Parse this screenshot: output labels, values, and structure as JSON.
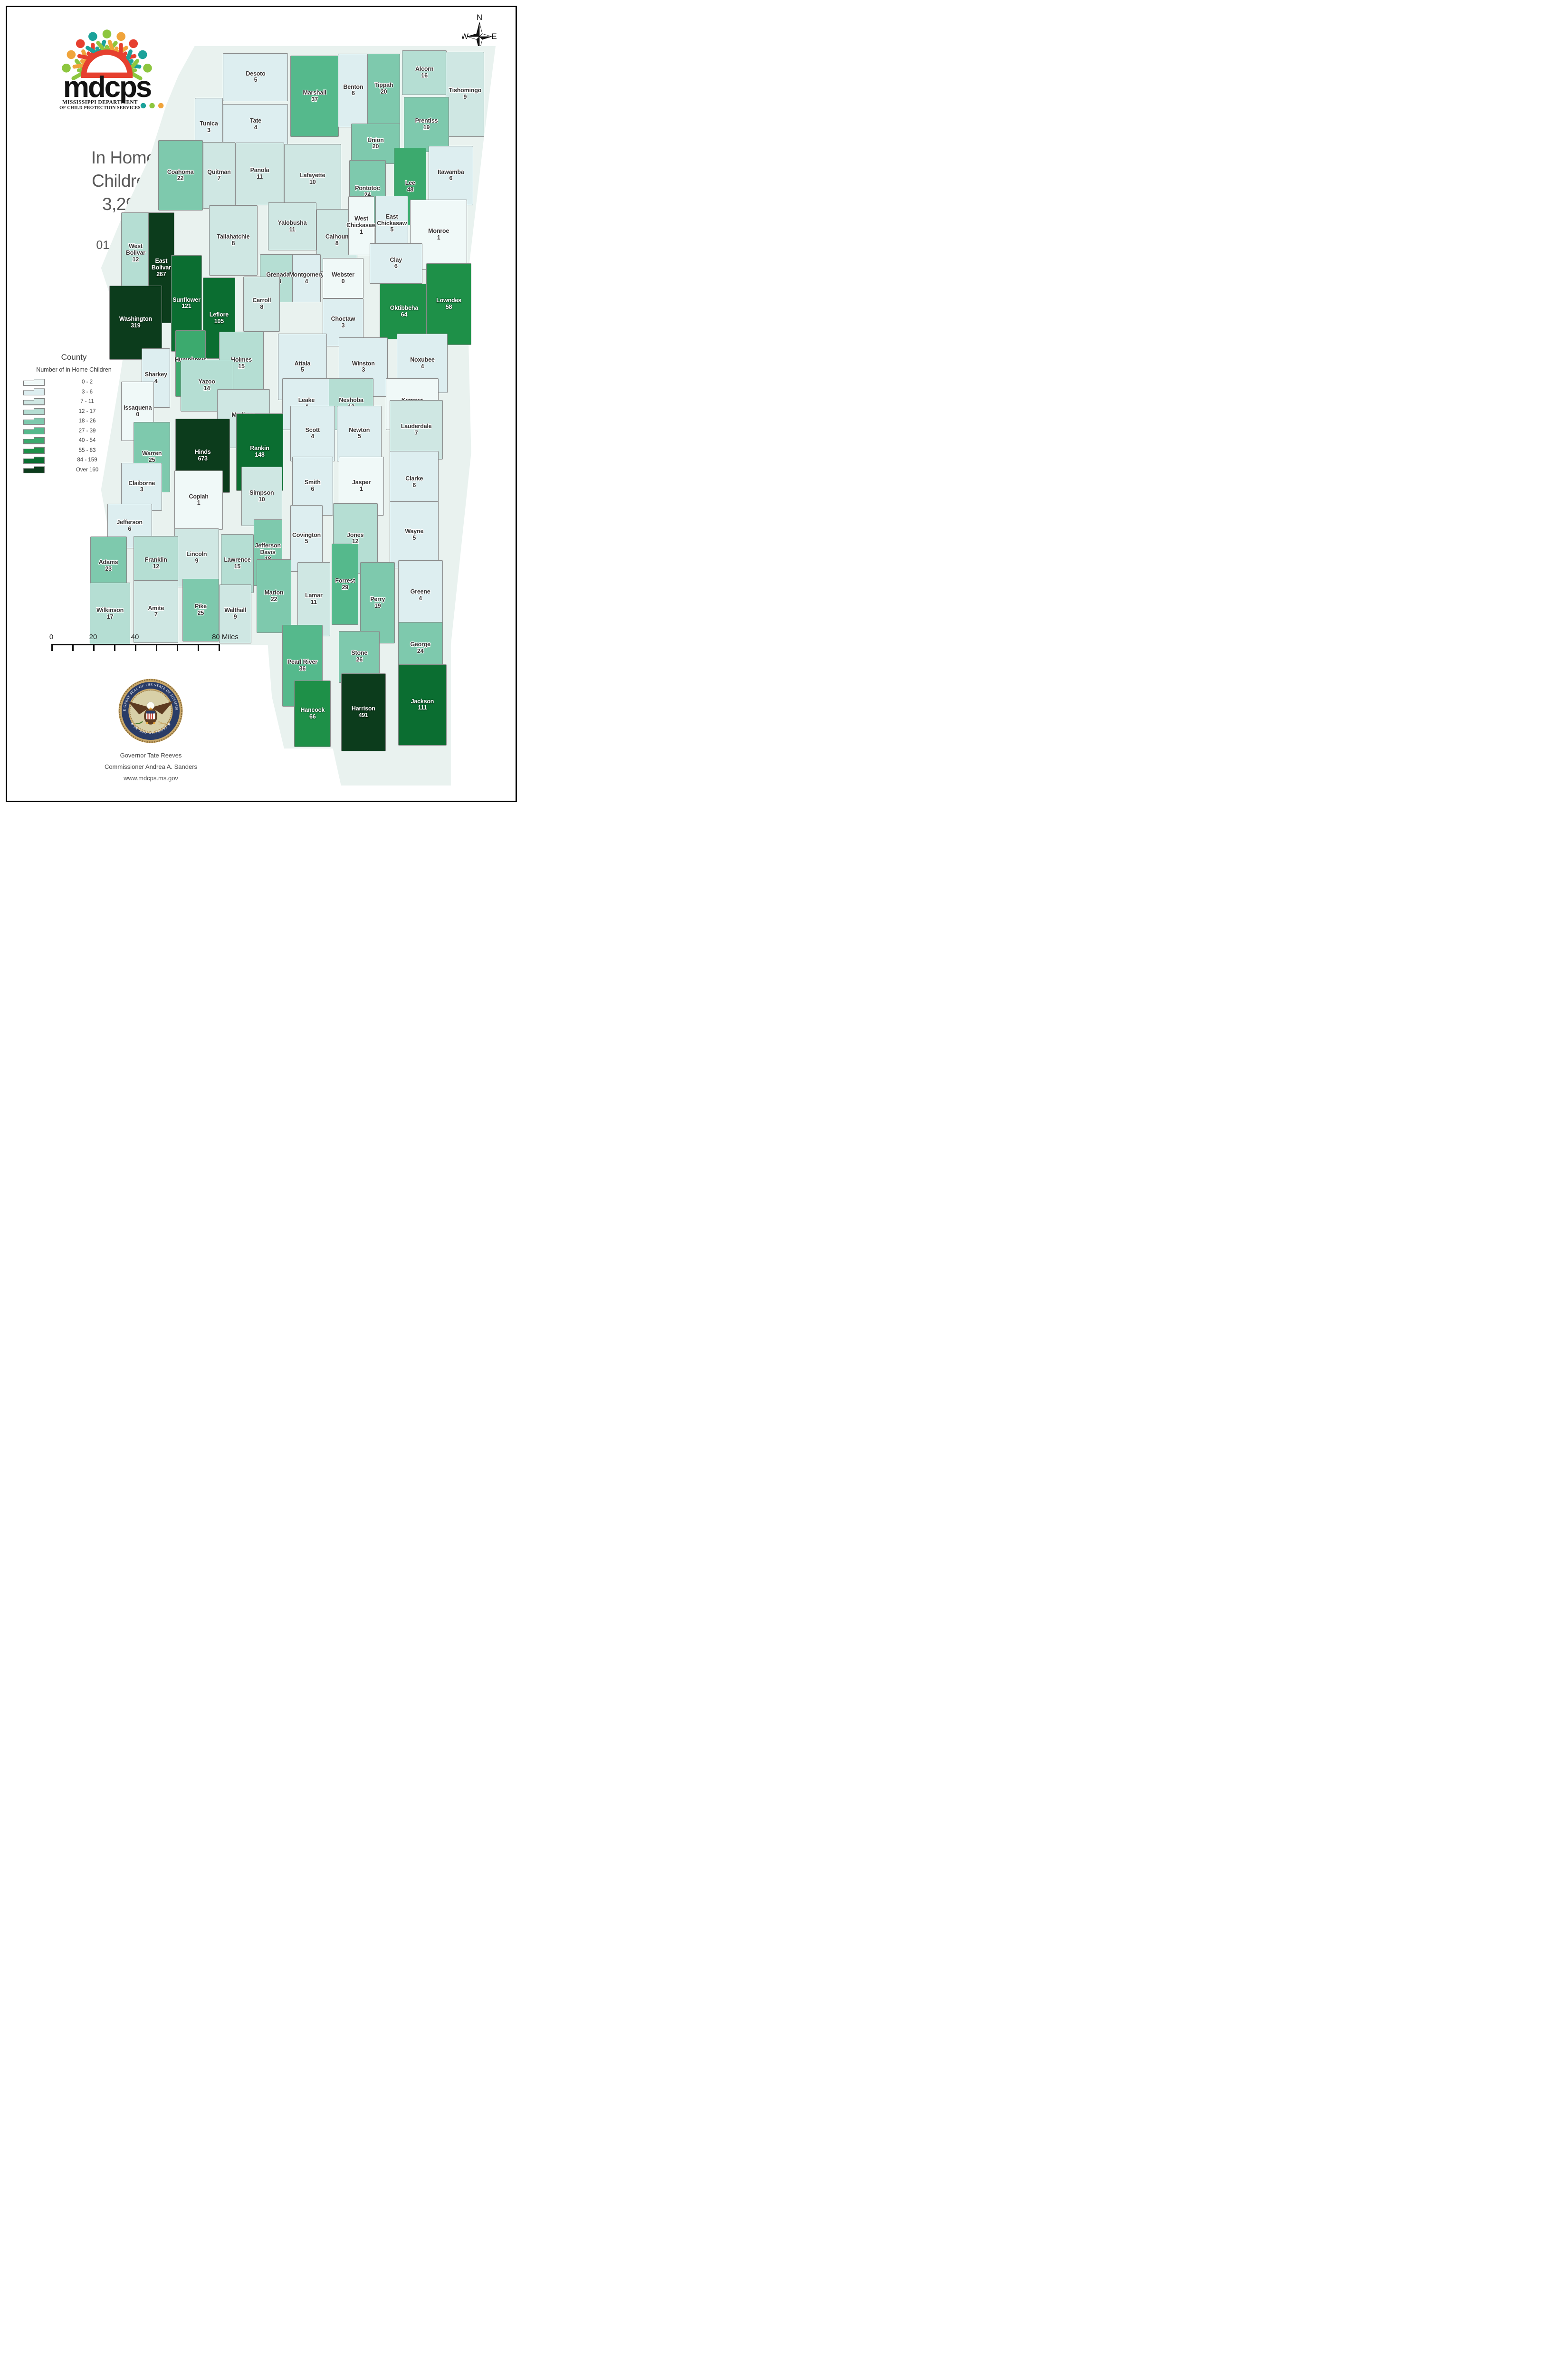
{
  "header": {
    "title_line1": "In Home",
    "title_line2": "Children",
    "total": "3,293",
    "date": "01-Mar-26"
  },
  "logo": {
    "wordmark": "mdcps",
    "dept_line1": "MISSISSIPPI DEPARTMENT",
    "dept_line2": "OF CHILD PROTECTION SERVICES",
    "palette": [
      "#1ba29a",
      "#8dc63f",
      "#f0a43b",
      "#e6402f"
    ]
  },
  "compass": {
    "n": "N",
    "e": "E",
    "s": "S",
    "w": "W"
  },
  "legend": {
    "title": "County",
    "subtitle": "Number of in Home Children",
    "classes": [
      {
        "label": "0 - 2",
        "color": "#f0f9f8"
      },
      {
        "label": "3 - 6",
        "color": "#ddeef0"
      },
      {
        "label": "7 - 11",
        "color": "#cfe7e3"
      },
      {
        "label": "12 - 17",
        "color": "#b5ded3"
      },
      {
        "label": "18 - 26",
        "color": "#7ec9ad"
      },
      {
        "label": "27 - 39",
        "color": "#55b98c"
      },
      {
        "label": "40 - 54",
        "color": "#3caa6e"
      },
      {
        "label": "55 - 83",
        "color": "#1e9048"
      },
      {
        "label": "84 - 159",
        "color": "#0b6e31"
      },
      {
        "label": "Over 160",
        "color": "#0c3c1c"
      }
    ]
  },
  "scalebar": {
    "labels": [
      "0",
      "20",
      "40",
      "80 Miles"
    ]
  },
  "seal": {
    "ring_text_top": "THE GREAT SEAL OF THE STATE OF MISSISSIPPI",
    "ring_text_bottom": "★ IN GOD WE TRUST ★"
  },
  "credits": {
    "line1": "Governor Tate Reeves",
    "line2": "Commissioner Andrea A. Sanders",
    "line3": "www.mdcps.ms.gov"
  },
  "map": {
    "type": "choropleth",
    "region": "Mississippi counties",
    "class_colors": [
      "#f0f9f8",
      "#ddeef0",
      "#cfe7e3",
      "#b5ded3",
      "#7ec9ad",
      "#55b98c",
      "#3caa6e",
      "#1e9048",
      "#0b6e31",
      "#0c3c1c"
    ],
    "counties": [
      {
        "name": "Desoto",
        "value": 5,
        "cls": 2,
        "x": 41,
        "y": 4.2,
        "w": 16,
        "h": 6.5
      },
      {
        "name": "Marshall",
        "value": 37,
        "cls": 6,
        "x": 55.5,
        "y": 6.8,
        "w": 12,
        "h": 11
      },
      {
        "name": "Benton",
        "value": 6,
        "cls": 2,
        "x": 65,
        "y": 6,
        "w": 7.5,
        "h": 10
      },
      {
        "name": "Tippah",
        "value": 20,
        "cls": 5,
        "x": 72.5,
        "y": 5.8,
        "w": 8,
        "h": 9.5
      },
      {
        "name": "Alcorn",
        "value": 16,
        "cls": 4,
        "x": 82.5,
        "y": 3.6,
        "w": 11,
        "h": 6
      },
      {
        "name": "Tishomingo",
        "value": 9,
        "cls": 3,
        "x": 92.5,
        "y": 6.5,
        "w": 9.5,
        "h": 11.5
      },
      {
        "name": "Tunica",
        "value": 3,
        "cls": 2,
        "x": 29.5,
        "y": 11,
        "w": 7,
        "h": 8
      },
      {
        "name": "Tate",
        "value": 4,
        "cls": 2,
        "x": 41,
        "y": 10.6,
        "w": 16,
        "h": 5.5
      },
      {
        "name": "Prentiss",
        "value": 19,
        "cls": 5,
        "x": 83,
        "y": 10.6,
        "w": 11,
        "h": 7.5
      },
      {
        "name": "Union",
        "value": 20,
        "cls": 5,
        "x": 70.5,
        "y": 13.2,
        "w": 12,
        "h": 5.5
      },
      {
        "name": "Coahoma",
        "value": 22,
        "cls": 5,
        "x": 22.5,
        "y": 17.5,
        "w": 11,
        "h": 9.5
      },
      {
        "name": "Quitman",
        "value": 7,
        "cls": 3,
        "x": 32,
        "y": 17.5,
        "w": 8,
        "h": 9
      },
      {
        "name": "Panola",
        "value": 11,
        "cls": 3,
        "x": 42,
        "y": 17.3,
        "w": 12,
        "h": 8.5
      },
      {
        "name": "Lafayette",
        "value": 10,
        "cls": 3,
        "x": 55,
        "y": 18,
        "w": 14,
        "h": 9.5
      },
      {
        "name": "Pontotoc",
        "value": 24,
        "cls": 5,
        "x": 68.5,
        "y": 19.7,
        "w": 9,
        "h": 8.5
      },
      {
        "name": "Lee",
        "value": 48,
        "cls": 7,
        "x": 79,
        "y": 19,
        "w": 8,
        "h": 10.5
      },
      {
        "name": "Itawamba",
        "value": 6,
        "cls": 2,
        "x": 89,
        "y": 17.5,
        "w": 11,
        "h": 8
      },
      {
        "name": "Monroe",
        "value": 1,
        "cls": 1,
        "x": 86,
        "y": 25.5,
        "w": 14,
        "h": 9.5
      },
      {
        "name": "Tallahatchie",
        "value": 8,
        "cls": 3,
        "x": 35.5,
        "y": 26.3,
        "w": 12,
        "h": 9.5
      },
      {
        "name": "Yalobusha",
        "value": 11,
        "cls": 3,
        "x": 50,
        "y": 24.4,
        "w": 12,
        "h": 6.5
      },
      {
        "name": "Calhoun",
        "value": 8,
        "cls": 3,
        "x": 61,
        "y": 26.3,
        "w": 10,
        "h": 8.5
      },
      {
        "name": "West Chickasaw",
        "value": 1,
        "cls": 1,
        "x": 67,
        "y": 24.3,
        "w": 6.5,
        "h": 8
      },
      {
        "name": "East Chickasaw",
        "value": 5,
        "cls": 2,
        "x": 74.5,
        "y": 24,
        "w": 8,
        "h": 7.5
      },
      {
        "name": "West Bolivar",
        "value": 12,
        "cls": 4,
        "x": 11.5,
        "y": 28,
        "w": 7,
        "h": 11
      },
      {
        "name": "East Bolivar",
        "value": 267,
        "cls": 10,
        "x": 17.8,
        "y": 30,
        "w": 6.5,
        "h": 15
      },
      {
        "name": "Sunflower",
        "value": 121,
        "cls": 9,
        "x": 24,
        "y": 34.8,
        "w": 7.5,
        "h": 13
      },
      {
        "name": "Leflore",
        "value": 105,
        "cls": 9,
        "x": 32,
        "y": 36.8,
        "w": 8,
        "h": 11
      },
      {
        "name": "Grenada",
        "value": 13,
        "cls": 4,
        "x": 46.5,
        "y": 31.4,
        "w": 9,
        "h": 6.5
      },
      {
        "name": "Montgomery",
        "value": 4,
        "cls": 2,
        "x": 53.5,
        "y": 31.4,
        "w": 7,
        "h": 6.5
      },
      {
        "name": "Webster",
        "value": 0,
        "cls": 1,
        "x": 62.5,
        "y": 31.4,
        "w": 10,
        "h": 5.5
      },
      {
        "name": "Clay",
        "value": 6,
        "cls": 2,
        "x": 75.5,
        "y": 29.4,
        "w": 13,
        "h": 5.5
      },
      {
        "name": "Washington",
        "value": 319,
        "cls": 10,
        "x": 11.5,
        "y": 37.4,
        "w": 13,
        "h": 10
      },
      {
        "name": "Humphreys",
        "value": 52,
        "cls": 7,
        "x": 25,
        "y": 42.9,
        "w": 7.5,
        "h": 9
      },
      {
        "name": "Sharkey",
        "value": 4,
        "cls": 2,
        "x": 16.5,
        "y": 44.9,
        "w": 7,
        "h": 8
      },
      {
        "name": "Carroll",
        "value": 8,
        "cls": 3,
        "x": 42.5,
        "y": 34.9,
        "w": 9,
        "h": 7.5
      },
      {
        "name": "Holmes",
        "value": 15,
        "cls": 4,
        "x": 37.5,
        "y": 42.9,
        "w": 11,
        "h": 8.5
      },
      {
        "name": "Choctaw",
        "value": 3,
        "cls": 2,
        "x": 62.5,
        "y": 37.4,
        "w": 10,
        "h": 6.5
      },
      {
        "name": "Oktibbeha",
        "value": 64,
        "cls": 8,
        "x": 77.5,
        "y": 35.9,
        "w": 12,
        "h": 7.5
      },
      {
        "name": "Lowndes",
        "value": 58,
        "cls": 8,
        "x": 88.5,
        "y": 34.9,
        "w": 11,
        "h": 11
      },
      {
        "name": "Attala",
        "value": 5,
        "cls": 2,
        "x": 52.5,
        "y": 43.4,
        "w": 12,
        "h": 9
      },
      {
        "name": "Winston",
        "value": 3,
        "cls": 2,
        "x": 67.5,
        "y": 43.4,
        "w": 12,
        "h": 8
      },
      {
        "name": "Noxubee",
        "value": 4,
        "cls": 2,
        "x": 82,
        "y": 42.9,
        "w": 12.5,
        "h": 8
      },
      {
        "name": "Yazoo",
        "value": 14,
        "cls": 4,
        "x": 29,
        "y": 45.9,
        "w": 13,
        "h": 7
      },
      {
        "name": "Leake",
        "value": 4,
        "cls": 2,
        "x": 53.5,
        "y": 48.4,
        "w": 12,
        "h": 7
      },
      {
        "name": "Neshoba",
        "value": 12,
        "cls": 4,
        "x": 64.5,
        "y": 48.4,
        "w": 11,
        "h": 7
      },
      {
        "name": "Kemper",
        "value": 0,
        "cls": 1,
        "x": 79.5,
        "y": 48.4,
        "w": 13,
        "h": 7
      },
      {
        "name": "Issaquena",
        "value": 0,
        "cls": 1,
        "x": 12,
        "y": 49.4,
        "w": 8,
        "h": 8
      },
      {
        "name": "Madison",
        "value": 8,
        "cls": 3,
        "x": 38,
        "y": 50.4,
        "w": 13,
        "h": 8
      },
      {
        "name": "Warren",
        "value": 25,
        "cls": 5,
        "x": 15.5,
        "y": 55.6,
        "w": 9,
        "h": 9.5
      },
      {
        "name": "Hinds",
        "value": 673,
        "cls": 10,
        "x": 28,
        "y": 55.4,
        "w": 13.5,
        "h": 10
      },
      {
        "name": "Rankin",
        "value": 148,
        "cls": 9,
        "x": 42,
        "y": 54.9,
        "w": 11.5,
        "h": 10.5
      },
      {
        "name": "Scott",
        "value": 4,
        "cls": 2,
        "x": 55,
        "y": 52.4,
        "w": 11,
        "h": 7.5
      },
      {
        "name": "Newton",
        "value": 5,
        "cls": 2,
        "x": 66.5,
        "y": 52.4,
        "w": 11,
        "h": 7.5
      },
      {
        "name": "Lauderdale",
        "value": 7,
        "cls": 3,
        "x": 80.5,
        "y": 51.9,
        "w": 13,
        "h": 8
      },
      {
        "name": "Claiborne",
        "value": 3,
        "cls": 2,
        "x": 13,
        "y": 59.6,
        "w": 10,
        "h": 6.5
      },
      {
        "name": "Copiah",
        "value": 1,
        "cls": 1,
        "x": 27,
        "y": 61.4,
        "w": 12,
        "h": 8
      },
      {
        "name": "Simpson",
        "value": 10,
        "cls": 3,
        "x": 42.5,
        "y": 60.9,
        "w": 10,
        "h": 8
      },
      {
        "name": "Smith",
        "value": 6,
        "cls": 2,
        "x": 55,
        "y": 59.5,
        "w": 10,
        "h": 8
      },
      {
        "name": "Jasper",
        "value": 1,
        "cls": 1,
        "x": 67,
        "y": 59.5,
        "w": 11,
        "h": 8
      },
      {
        "name": "Clarke",
        "value": 6,
        "cls": 2,
        "x": 80,
        "y": 59,
        "w": 12,
        "h": 8.5
      },
      {
        "name": "Jefferson",
        "value": 6,
        "cls": 2,
        "x": 10,
        "y": 64.9,
        "w": 11,
        "h": 6
      },
      {
        "name": "Lincoln",
        "value": 9,
        "cls": 3,
        "x": 26.5,
        "y": 69.2,
        "w": 11,
        "h": 8
      },
      {
        "name": "Lawrence",
        "value": 15,
        "cls": 4,
        "x": 36.5,
        "y": 70,
        "w": 8,
        "h": 8
      },
      {
        "name": "Jefferson Davis",
        "value": 18,
        "cls": 5,
        "x": 44,
        "y": 68.5,
        "w": 7,
        "h": 9
      },
      {
        "name": "Covington",
        "value": 5,
        "cls": 2,
        "x": 53.5,
        "y": 66.6,
        "w": 8,
        "h": 9
      },
      {
        "name": "Jones",
        "value": 12,
        "cls": 4,
        "x": 65.5,
        "y": 66.6,
        "w": 11,
        "h": 9.5
      },
      {
        "name": "Wayne",
        "value": 5,
        "cls": 2,
        "x": 80,
        "y": 66.1,
        "w": 12,
        "h": 9
      },
      {
        "name": "Adams",
        "value": 23,
        "cls": 5,
        "x": 4.8,
        "y": 70.3,
        "w": 9,
        "h": 8
      },
      {
        "name": "Franklin",
        "value": 12,
        "cls": 4,
        "x": 16.5,
        "y": 70,
        "w": 11,
        "h": 7.5
      },
      {
        "name": "Wilkinson",
        "value": 17,
        "cls": 4,
        "x": 5.2,
        "y": 76.8,
        "w": 10,
        "h": 8.5
      },
      {
        "name": "Amite",
        "value": 7,
        "cls": 3,
        "x": 16.5,
        "y": 76.5,
        "w": 11,
        "h": 8.5
      },
      {
        "name": "Pike",
        "value": 25,
        "cls": 5,
        "x": 27.5,
        "y": 76.3,
        "w": 9,
        "h": 8.5
      },
      {
        "name": "Walthall",
        "value": 9,
        "cls": 3,
        "x": 36,
        "y": 76.8,
        "w": 8,
        "h": 8
      },
      {
        "name": "Marion",
        "value": 22,
        "cls": 5,
        "x": 45.5,
        "y": 74.4,
        "w": 8.5,
        "h": 10
      },
      {
        "name": "Lamar",
        "value": 11,
        "cls": 3,
        "x": 55.3,
        "y": 74.8,
        "w": 8,
        "h": 10
      },
      {
        "name": "Forrest",
        "value": 29,
        "cls": 6,
        "x": 63,
        "y": 72.8,
        "w": 6.5,
        "h": 11
      },
      {
        "name": "Perry",
        "value": 19,
        "cls": 5,
        "x": 71,
        "y": 75.3,
        "w": 8.5,
        "h": 11
      },
      {
        "name": "Greene",
        "value": 4,
        "cls": 2,
        "x": 81.5,
        "y": 74.3,
        "w": 11,
        "h": 9.5
      },
      {
        "name": "Pearl River",
        "value": 36,
        "cls": 6,
        "x": 52.5,
        "y": 83.8,
        "w": 10,
        "h": 11
      },
      {
        "name": "Stone",
        "value": 26,
        "cls": 5,
        "x": 66.5,
        "y": 82.6,
        "w": 10,
        "h": 7
      },
      {
        "name": "George",
        "value": 24,
        "cls": 5,
        "x": 81.5,
        "y": 81.4,
        "w": 11,
        "h": 7
      },
      {
        "name": "Hancock",
        "value": 66,
        "cls": 8,
        "x": 55,
        "y": 90.3,
        "w": 9,
        "h": 9
      },
      {
        "name": "Harrison",
        "value": 491,
        "cls": 10,
        "x": 67.5,
        "y": 90.1,
        "w": 11,
        "h": 10.5
      },
      {
        "name": "Jackson",
        "value": 111,
        "cls": 9,
        "x": 82,
        "y": 89.1,
        "w": 12,
        "h": 11
      }
    ]
  }
}
